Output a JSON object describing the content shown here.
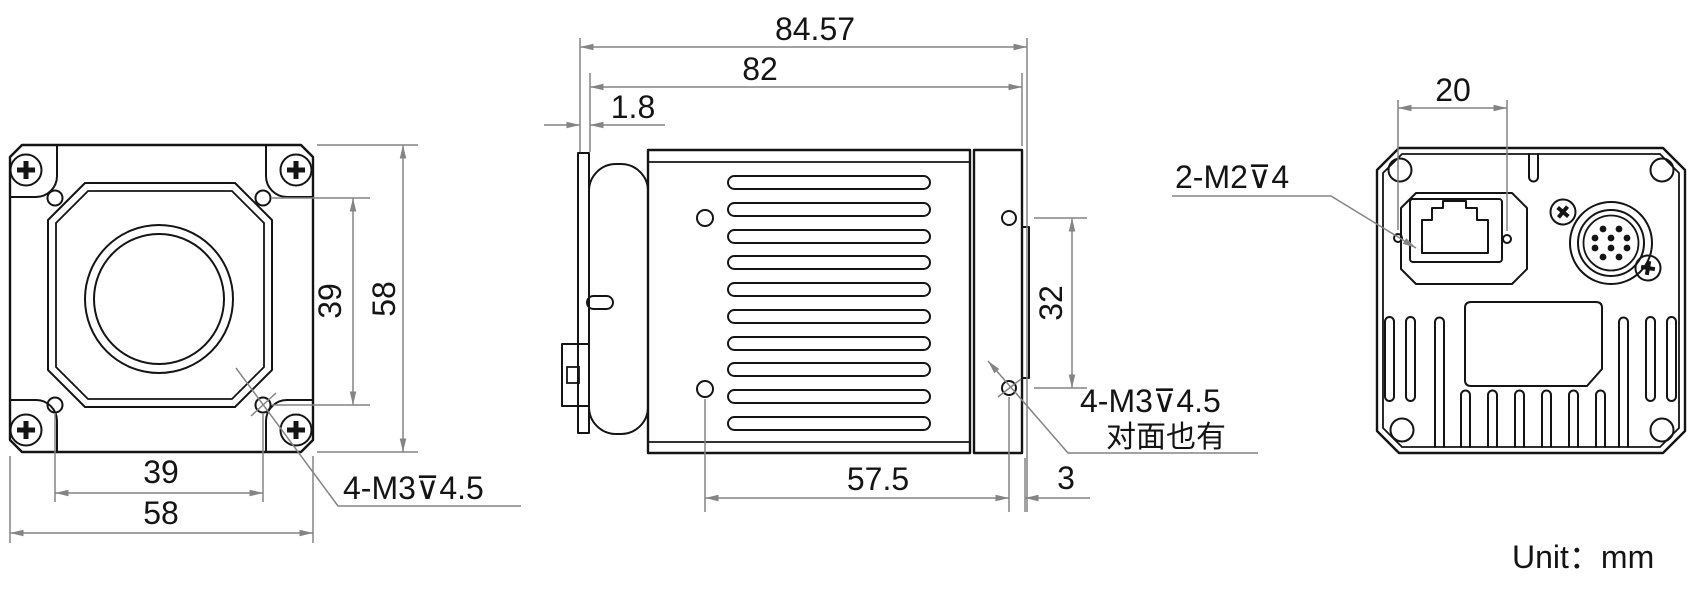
{
  "front_view": {
    "dim_hole_span_v": "39",
    "dim_height": "58",
    "dim_hole_span_h": "39",
    "dim_width": "58",
    "mount_hole_note": "4-M3⊽4.5"
  },
  "side_view": {
    "dim_total_depth": "84.57",
    "dim_body_depth": "82",
    "dim_front_flange": "1.8",
    "dim_rear_hole_span": "32",
    "dim_hole_span_h": "57.5",
    "dim_rear_offset": "3",
    "mount_hole_note": "4-M3⊽4.5",
    "mount_hole_note_extra": "对面也有"
  },
  "back_view": {
    "dim_hole_span": "20",
    "mount_hole_note": "2-M2⊽4"
  },
  "footer": {
    "unit_note": "Unit：mm"
  },
  "colors": {
    "line": "#141414",
    "dimension": "#848484",
    "background": "#ffffff"
  }
}
